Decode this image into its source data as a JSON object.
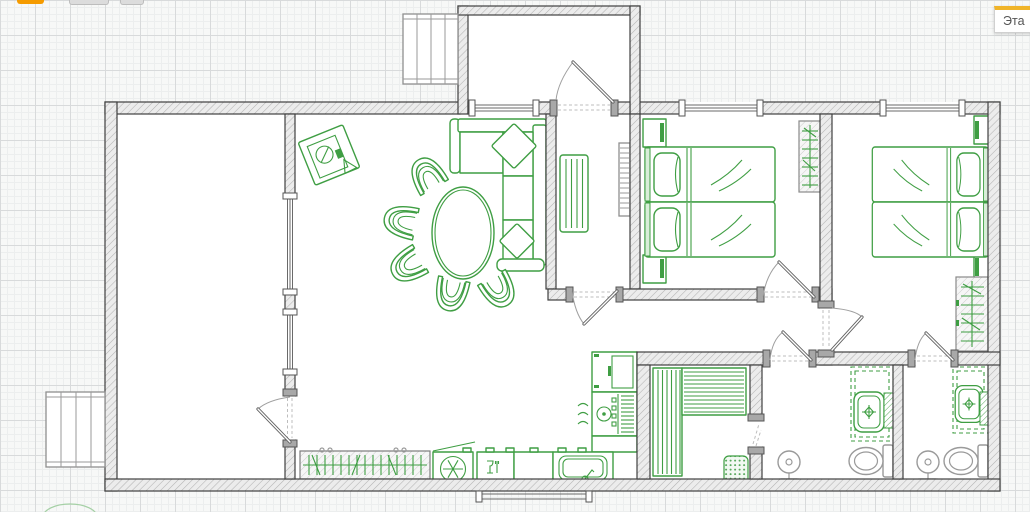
{
  "floor_badge": {
    "label": "Эта"
  },
  "toolbar_fragments": {
    "count": 3,
    "colors": [
      "#f59b00",
      "#dcdcdc",
      "#dcdcdc"
    ]
  },
  "palette": {
    "canvas_bg": "#f7f8f7",
    "grid_minor": "#eceeee",
    "grid_major": "#d8dadb",
    "furniture_green": "#3f9e43",
    "soft_green": "#e9f4e9",
    "fixture_gray": "#9a9a9a",
    "wall_edge": "#3f3f3f",
    "accent_orange": "#f59b00",
    "badge_text": "#555555"
  },
  "scene": {
    "rooms": [
      "storage-room",
      "living-room",
      "entry-hall",
      "porch",
      "bedroom-1",
      "bedroom-2",
      "kitchen-nook",
      "sauna",
      "bathroom-1",
      "bathroom-2"
    ],
    "objects": [
      "exterior-stairs-top",
      "exterior-stairs-left",
      "washing-machine",
      "corner-sofa",
      "dining-table",
      "dining-chair",
      "sideboard",
      "hall-radiator",
      "towel-ladder",
      "single-bed",
      "nightstand",
      "wardrobe",
      "tall-cabinet",
      "stove",
      "fridge",
      "dishwasher",
      "kitchen-sink",
      "counter",
      "sauna-bench",
      "sauna-heater",
      "vanity",
      "wash-basin",
      "towel",
      "toilet",
      "shower-mixer",
      "plant"
    ]
  }
}
